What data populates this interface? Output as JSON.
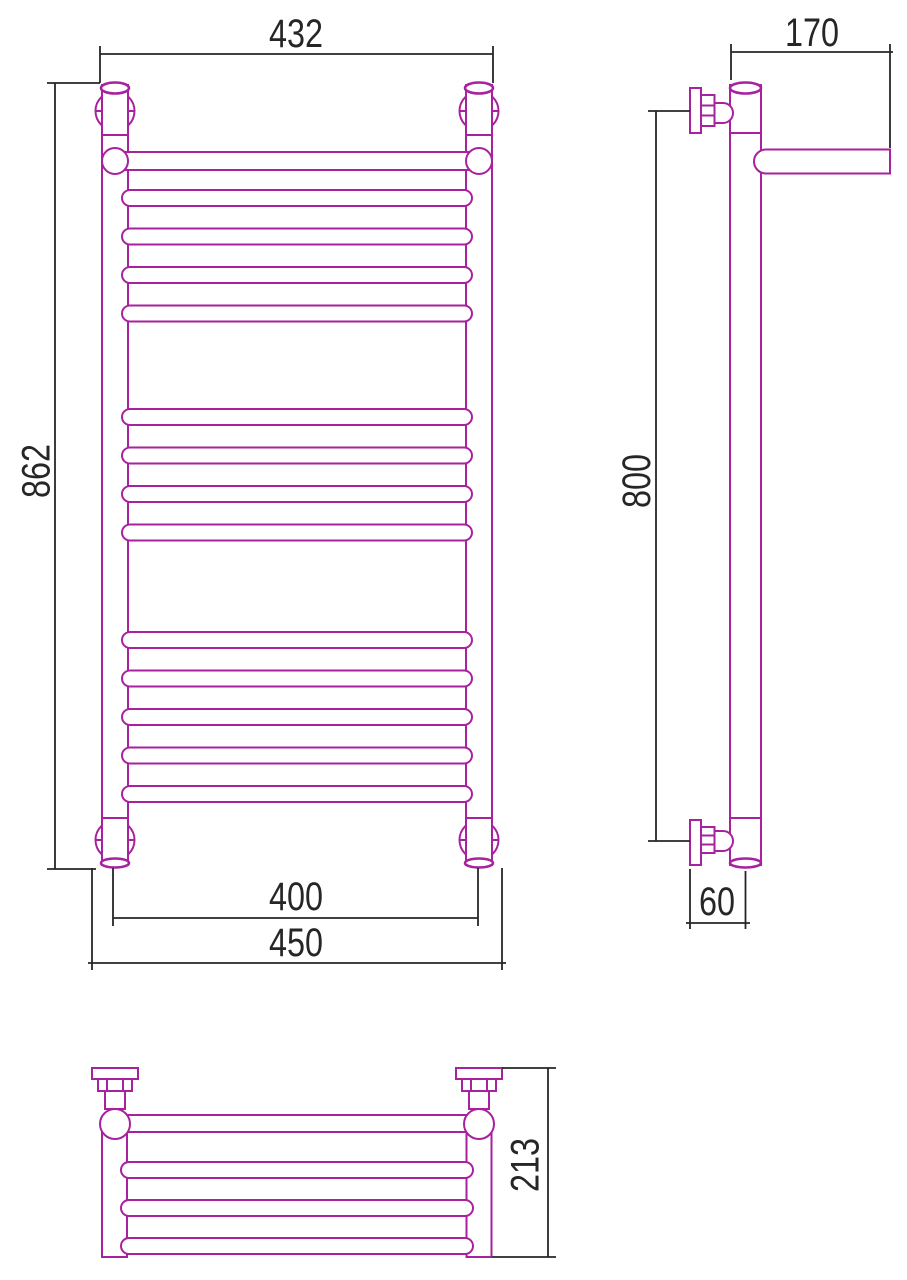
{
  "drawing": {
    "subject": "heated towel rail with top shelf - three orthographic views",
    "line_color": "#a8219e",
    "dim_color": "#262626",
    "background": "#ffffff",
    "dims": {
      "top_width": {
        "value": "432"
      },
      "height": {
        "value": "862"
      },
      "center_distance": {
        "value": "400"
      },
      "overall_width": {
        "value": "450"
      },
      "depth": {
        "value": "170"
      },
      "mount_height": {
        "value": "800"
      },
      "wall_offset": {
        "value": "60"
      },
      "shelf_depth": {
        "value": "213"
      }
    },
    "front_rungs": {
      "x": 122,
      "width": 350,
      "height": 16,
      "rx": 8,
      "tops": [
        190,
        228.5,
        267,
        305.5,
        409,
        447.5,
        486,
        524.5,
        632,
        670.5,
        709,
        747.5,
        786
      ]
    },
    "shelf_rungs": {
      "x": 121,
      "width": 352,
      "height": 16,
      "rx": 8,
      "tops": [
        1162,
        1200,
        1238
      ]
    }
  }
}
